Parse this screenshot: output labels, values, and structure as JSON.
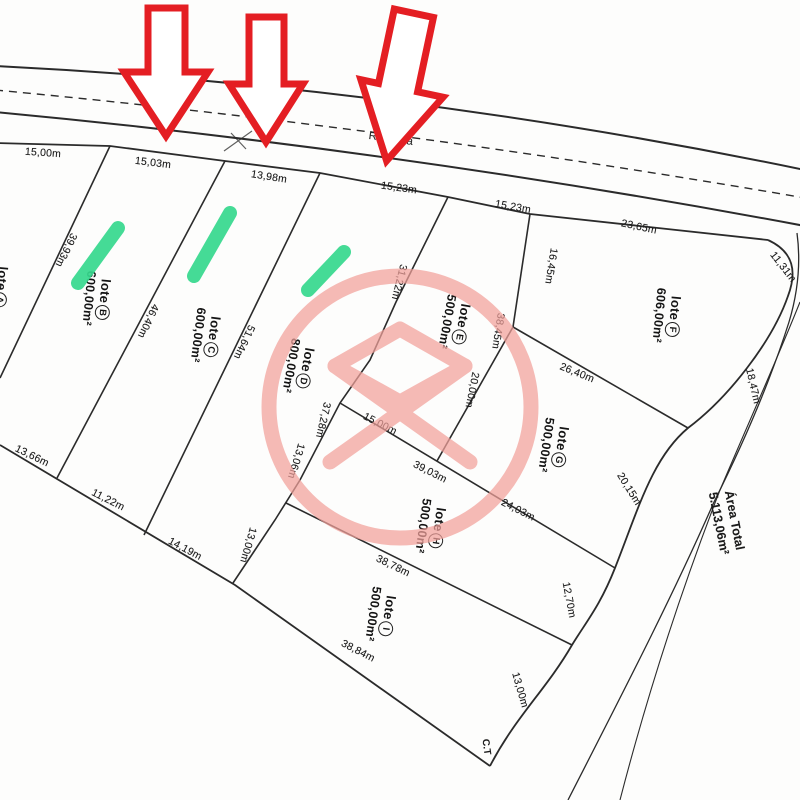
{
  "road": {
    "name": "Rodovia"
  },
  "corner_marker": "C.T",
  "total_area": {
    "title": "Área Total",
    "value": "5.113,06m²"
  },
  "lots": [
    {
      "name": "lote",
      "letter": "A",
      "area": ""
    },
    {
      "name": "lote",
      "letter": "B",
      "area": "600,00m²"
    },
    {
      "name": "lote",
      "letter": "C",
      "area": "600,00m²"
    },
    {
      "name": "lote",
      "letter": "D",
      "area": "800,00m²"
    },
    {
      "name": "lote",
      "letter": "E",
      "area": "500,00m²"
    },
    {
      "name": "lote",
      "letter": "F",
      "area": "606,00m²"
    },
    {
      "name": "lote",
      "letter": "G",
      "area": "500,00m²"
    },
    {
      "name": "lote",
      "letter": "H",
      "area": "500,00m²"
    },
    {
      "name": "lote",
      "letter": "I",
      "area": "500,00m²"
    }
  ],
  "measurements": {
    "dims": [
      "15,00m",
      "15,03m",
      "13,98m",
      "15,23m",
      "15,23m",
      "23,65m",
      "11,31m",
      "39,93m",
      "46,40m",
      "51,64m",
      "31,22m",
      "37,28m",
      "13,06m",
      "13,00m",
      "16,45m",
      "38,45m",
      "20,00m",
      "26,40m",
      "18,47m",
      "20,15m",
      "15,00m",
      "39,03m",
      "24,03m",
      "38,78m",
      "38,84m",
      "12,70m",
      "13,00m",
      "13,66m",
      "11,22m",
      "14,19m"
    ]
  },
  "colors": {
    "ink": "#2b2b2b",
    "arrow_red": "#e41e23",
    "highlight_green": "#36d98e",
    "watermark_pink": "#f2a19b"
  }
}
